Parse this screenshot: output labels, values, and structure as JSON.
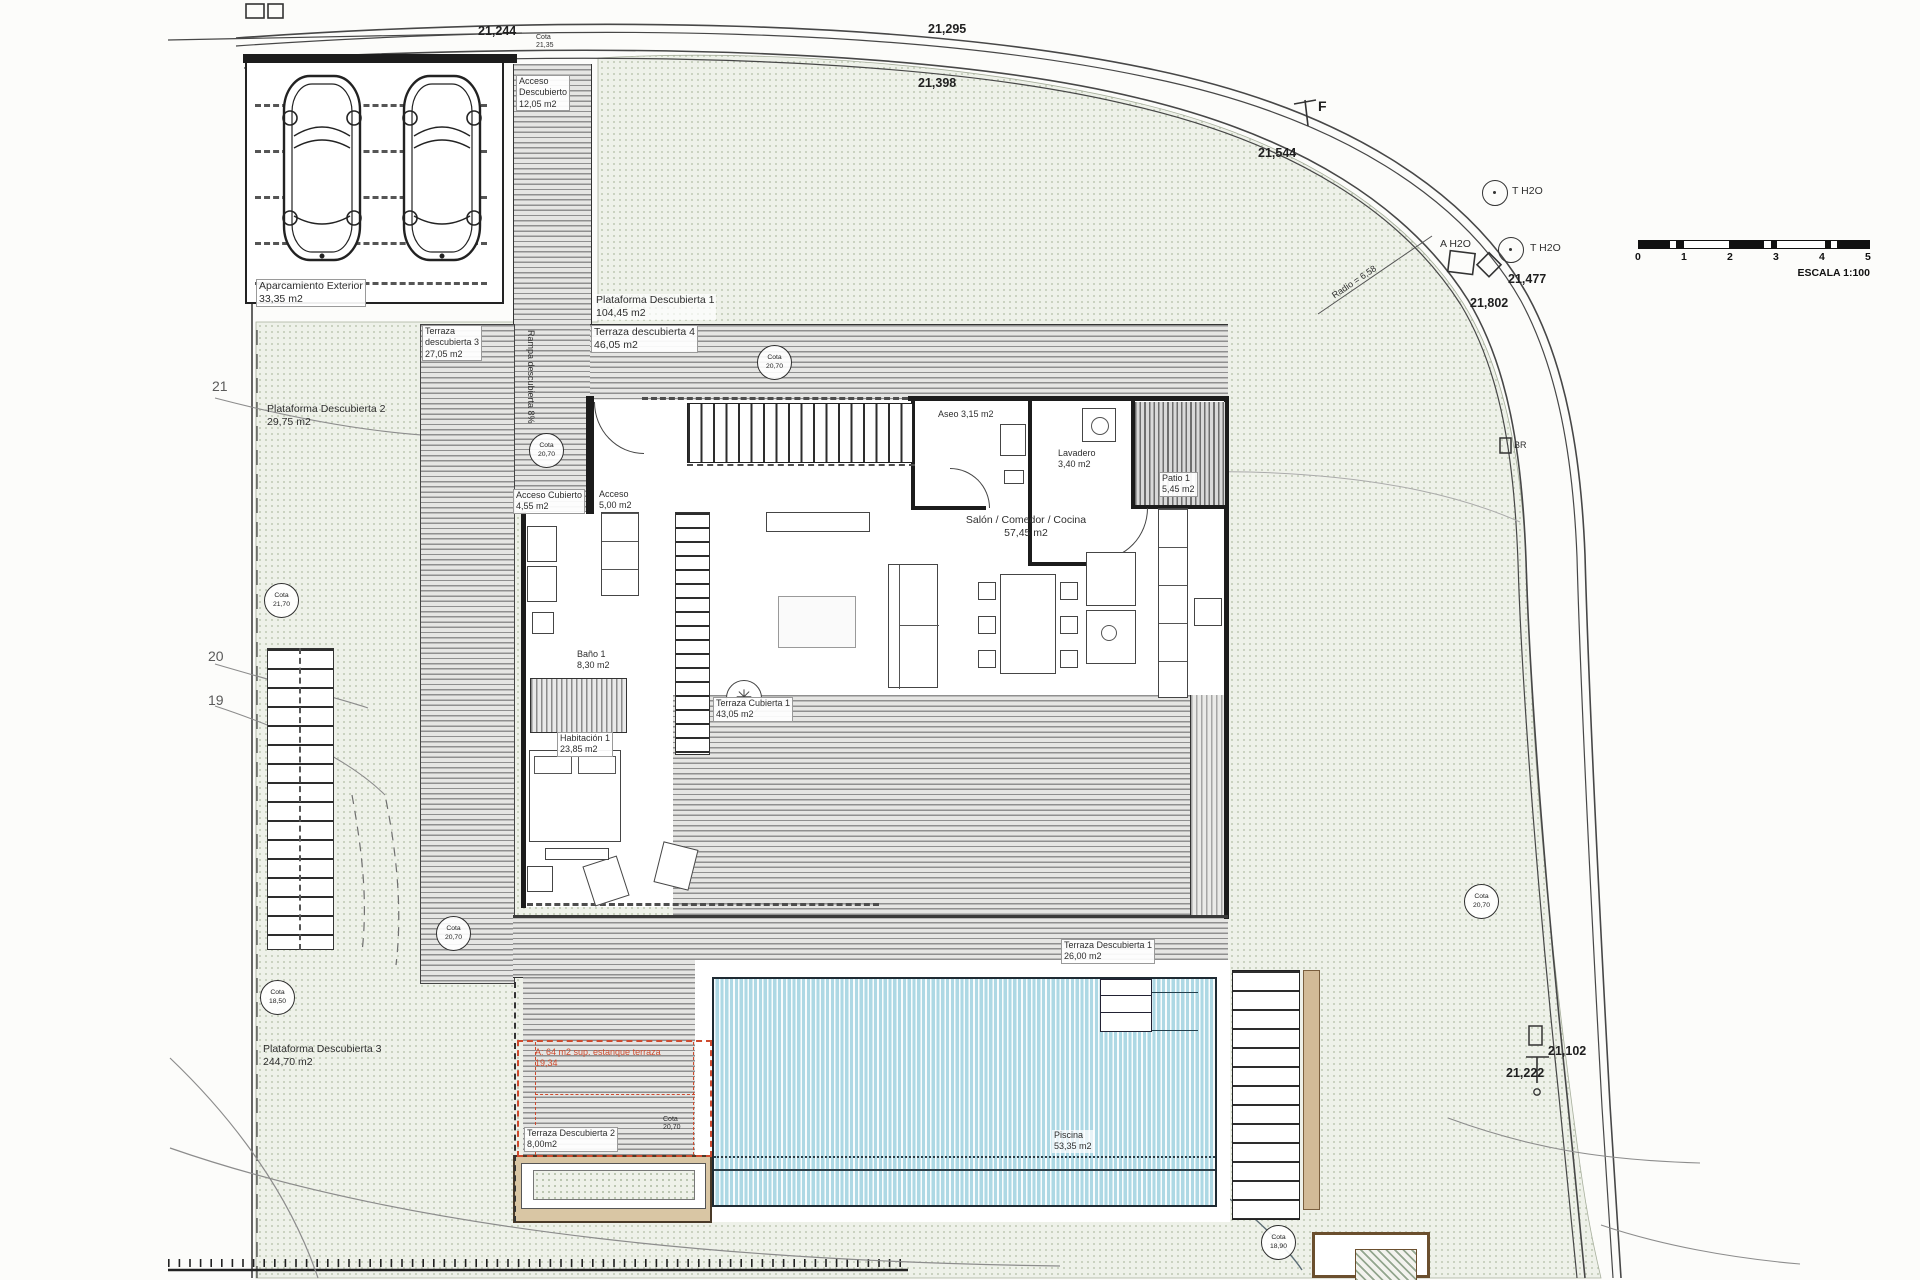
{
  "colors": {
    "terrain_dot": "#b0bca4",
    "deck_line": "#8f8f8f",
    "pool_fill": "#cfe9f1",
    "tan_wall": "#d2bb97",
    "red_annotation": "#cf4b2e",
    "wall": "#1c1c1c"
  },
  "scalebar": {
    "ticks": [
      "0",
      "1",
      "2",
      "3",
      "4",
      "5"
    ],
    "label": "ESCALA 1:100"
  },
  "contour_labels": {
    "l21": "21",
    "l20": "20",
    "l19": "19"
  },
  "dims": {
    "d21244": "21,244",
    "d21295": "21,295",
    "d21398": "21,398",
    "d21544": "21,544",
    "d21477": "21,477",
    "d21802": "21,802",
    "d21102": "21,102",
    "d21222": "21,222"
  },
  "road": {
    "f": "F",
    "radio": "Radio = 6,58",
    "t_h2o_1": "T H2O",
    "t_h2o_2": "T H2O",
    "a_h2o": "A H2O",
    "br": "BR"
  },
  "cotas": {
    "word": "Cota",
    "c_top": "21,35",
    "c_ramp": "20,70",
    "c_terrace": "20,70",
    "c_left": "21,70",
    "c_walk": "20,70",
    "c_left_low": "18,50",
    "c_hill": "20,70",
    "c_pool": "18,90",
    "c_small": "20,70"
  },
  "rooms": {
    "aparcamiento": {
      "name": "Aparcamiento Exterior",
      "area": "33,35 m2"
    },
    "acceso_desc": {
      "l1": "Acceso",
      "l2": "Descubierto",
      "area": "12,05 m2"
    },
    "plataforma1": {
      "name": "Plataforma Descubierta 1",
      "area": "104,45 m2"
    },
    "terraza4": {
      "name": "Terraza descubierta 4",
      "area": "46,05 m2"
    },
    "terraza3": {
      "l1": "Terraza",
      "l2": "descubierta 3",
      "area": "27,05 m2"
    },
    "plataforma2": {
      "name": "Plataforma Descubierta 2",
      "area": "29,75 m2"
    },
    "plataforma3": {
      "name": "Plataforma Descubierta 3",
      "area": "244,70 m2"
    },
    "aseo": {
      "name": "Aseo 3,15 m2"
    },
    "lavadero": {
      "name": "Lavadero",
      "area": "3,40 m2"
    },
    "patio": {
      "name": "Patio 1",
      "area": "5,45 m2"
    },
    "salon": {
      "name": "Salón / Comedor / Cocina",
      "area": "57,45 m2"
    },
    "acceso_cub": {
      "name": "Acceso Cubierto",
      "area": "4,55 m2"
    },
    "acceso": {
      "name": "Acceso",
      "area": "5,00 m2"
    },
    "bano": {
      "name": "Baño 1",
      "area": "8,30 m2"
    },
    "habitacion": {
      "name": "Habitación 1",
      "area": "23,85 m2"
    },
    "terraza_cub1": {
      "name": "Terraza Cubierta 1",
      "area": "43,05 m2"
    },
    "terraza_desc1": {
      "name": "Terraza Descubierta 1",
      "area": "26,00 m2"
    },
    "terraza_desc2": {
      "name": "Terraza Descubierta 2",
      "area": "8,00m2"
    },
    "piscina": {
      "name": "Piscina",
      "area": "53,35 m2"
    }
  },
  "annotations": {
    "rampa": "Rampa descubierta 8%",
    "red_line1": "A: 64 m2 sup. estanque terraza",
    "red_line2": "19,34"
  }
}
